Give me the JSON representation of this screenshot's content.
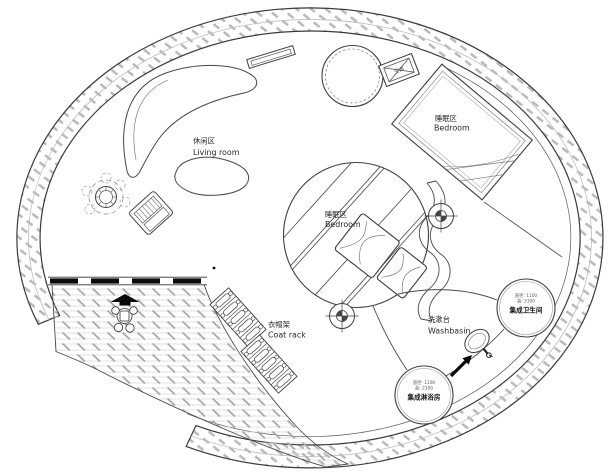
{
  "plan": {
    "rooms": {
      "living_room": {
        "zh": "休闲区",
        "en": "Living room"
      },
      "bedroom_upper": {
        "zh": "睡眠区",
        "en": "Bedroom"
      },
      "bedroom_center": {
        "zh": "睡眠区",
        "en": "Bedroom"
      },
      "coat_rack": {
        "zh": "衣帽架",
        "en": "Coat rack"
      },
      "washbasin": {
        "zh": "洗漱台",
        "en": "Washbasin"
      },
      "bathroom_pod": {
        "name": "集成卫生间",
        "spec1": "直径: 1100",
        "spec2": "高: 2100"
      },
      "shower_pod": {
        "name": "集成淋浴房",
        "spec1": "直径: 1100",
        "spec2": "高: 2100"
      },
      "ac_unit": {
        "zh": "空调"
      }
    },
    "colors": {
      "background": "#ffffff",
      "line": "#3f3f3f",
      "hatch_ring": "#b7b7b7",
      "hatch_terrace": "#a9a9a9",
      "black_fill": "#0a0a0a"
    }
  }
}
